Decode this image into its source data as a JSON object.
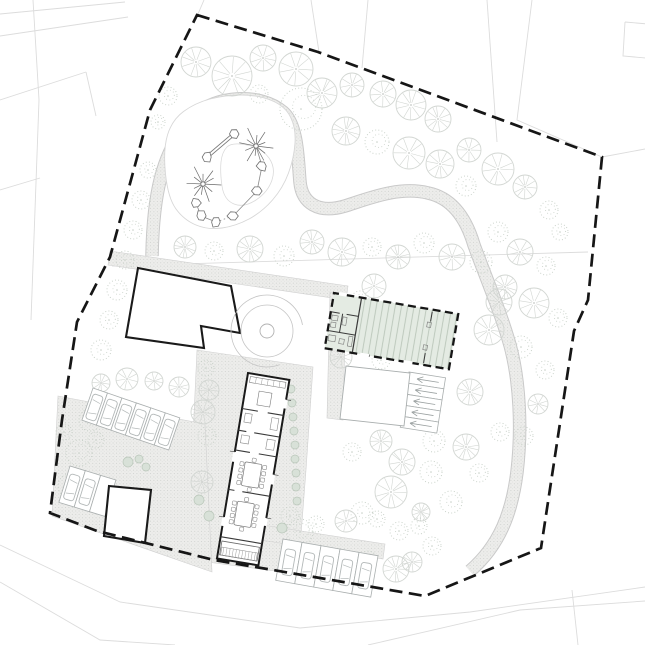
{
  "canvas": {
    "w": 645,
    "h": 645,
    "background": "#ffffff"
  },
  "colors": {
    "boundary": "#161616",
    "context_line": "#dcdcdc",
    "paving_edge": "#d0d0d0",
    "stipple_base": "#ededeb",
    "stipple_dot": "#c7cac7",
    "heavy_wall": "#1a1a1a",
    "thin_wall": "#3a3a3a",
    "light_outline": "#a9aeae",
    "car_line": "#b3b8b8",
    "tree_outline": "#d2d6d2",
    "tree_stipple": "#c6cfc6",
    "bush_fill": "#d8e1d8",
    "bush_edge": "#b9c6b9",
    "green_fill": "#e4ebe3",
    "green_hatch": "#b9c5b8",
    "equipment": "#6a6a6a",
    "circle_feature": "#c4c4c4",
    "blob_edge": "#d7d7d7"
  },
  "site_boundary": {
    "points": [
      [
        197,
        15
      ],
      [
        318,
        52
      ],
      [
        602,
        157
      ],
      [
        588,
        300
      ],
      [
        574,
        331
      ],
      [
        541,
        548
      ],
      [
        425,
        596
      ],
      [
        320,
        578
      ],
      [
        214,
        560
      ],
      [
        97,
        531
      ],
      [
        50,
        513
      ],
      [
        62,
        420
      ],
      [
        77,
        322
      ],
      [
        110,
        257
      ],
      [
        150,
        110
      ]
    ],
    "dash": "13 6.5",
    "width": 2.7
  },
  "context_lines": [
    [
      [
        204,
        0
      ],
      [
        198,
        14
      ]
    ],
    [
      [
        311,
        0
      ],
      [
        319,
        52
      ]
    ],
    [
      [
        368,
        0
      ],
      [
        362,
        68
      ]
    ],
    [
      [
        487,
        0
      ],
      [
        497,
        142
      ]
    ],
    [
      [
        532,
        0
      ],
      [
        517,
        120
      ],
      [
        602,
        157
      ]
    ],
    [
      [
        602,
        157
      ],
      [
        645,
        149
      ]
    ],
    [
      [
        625,
        22
      ],
      [
        648,
        24
      ],
      [
        646,
        58
      ],
      [
        623,
        56
      ],
      [
        625,
        22
      ]
    ],
    [
      [
        0,
        14
      ],
      [
        125,
        2
      ]
    ],
    [
      [
        0,
        36
      ],
      [
        128,
        17
      ]
    ],
    [
      [
        0,
        100
      ],
      [
        86,
        72
      ]
    ],
    [
      [
        86,
        72
      ],
      [
        96,
        116
      ]
    ],
    [
      [
        0,
        190
      ],
      [
        40,
        178
      ]
    ],
    [
      [
        33,
        0
      ],
      [
        39,
        100
      ],
      [
        31,
        320
      ]
    ],
    [
      [
        112,
        266
      ],
      [
        588,
        252
      ]
    ],
    [
      [
        0,
        545
      ],
      [
        120,
        602
      ],
      [
        300,
        628
      ],
      [
        470,
        612
      ],
      [
        645,
        587
      ]
    ],
    [
      [
        0,
        582
      ],
      [
        100,
        640
      ],
      [
        175,
        645
      ]
    ],
    [
      [
        368,
        645
      ],
      [
        520,
        610
      ],
      [
        645,
        601
      ]
    ],
    [
      [
        572,
        590
      ],
      [
        578,
        645
      ]
    ]
  ],
  "paving_polygons": [
    [
      [
        110,
        251
      ],
      [
        348,
        286
      ],
      [
        346,
        300
      ],
      [
        108,
        265
      ]
    ],
    [
      [
        330,
        292
      ],
      [
        346,
        294
      ],
      [
        343,
        420
      ],
      [
        327,
        418
      ]
    ],
    [
      [
        197,
        350
      ],
      [
        313,
        367
      ],
      [
        306,
        470
      ],
      [
        298,
        574
      ],
      [
        207,
        562
      ],
      [
        192,
        458
      ]
    ],
    [
      [
        58,
        396
      ],
      [
        205,
        424
      ],
      [
        212,
        572
      ],
      [
        52,
        516
      ]
    ],
    [
      [
        256,
        524
      ],
      [
        385,
        544
      ],
      [
        383,
        559
      ],
      [
        254,
        539
      ]
    ]
  ],
  "serpentine_path": {
    "d": "M152,256 C153,200 160,150 195,115 C215,96 260,92 283,112 C298,125 298,160 300,182 C302,203 318,214 345,206 C370,198 400,186 428,193 C452,198 466,218 474,245 C486,278 500,310 510,345 C520,382 522,430 517,472 C512,512 500,545 470,571",
    "outer_width": 13.5,
    "inner_width": 11.5
  },
  "playground": {
    "outer_blob": [
      [
        163,
        150
      ],
      [
        172,
        120
      ],
      [
        195,
        103
      ],
      [
        225,
        95
      ],
      [
        258,
        95
      ],
      [
        285,
        106
      ],
      [
        296,
        128
      ],
      [
        294,
        158
      ],
      [
        283,
        188
      ],
      [
        262,
        212
      ],
      [
        236,
        226
      ],
      [
        208,
        230
      ],
      [
        184,
        220
      ],
      [
        168,
        198
      ]
    ],
    "inner_blob": [
      [
        232,
        142
      ],
      [
        262,
        148
      ],
      [
        276,
        168
      ],
      [
        268,
        192
      ],
      [
        244,
        208
      ],
      [
        224,
        200
      ],
      [
        220,
        172
      ],
      [
        222,
        152
      ]
    ],
    "stars": [
      {
        "x": 256,
        "y": 146,
        "r": 18
      },
      {
        "x": 203,
        "y": 184,
        "r": 17
      }
    ],
    "beam": {
      "x1": 234,
      "y1": 134,
      "x2": 207,
      "y2": 157
    },
    "rocks": [
      [
        234,
        134
      ],
      [
        207,
        157
      ],
      [
        196,
        203
      ],
      [
        201,
        216
      ],
      [
        216,
        222
      ],
      [
        233,
        216
      ],
      [
        257,
        191
      ],
      [
        262,
        166
      ]
    ],
    "links": [
      {
        "a": [
          196,
          203
        ],
        "b": [
          201,
          216
        ],
        "dotted": false
      },
      {
        "a": [
          201,
          216
        ],
        "b": [
          216,
          222
        ],
        "dotted": false
      },
      {
        "a": [
          216,
          222
        ],
        "b": [
          233,
          216
        ],
        "dotted": true
      },
      {
        "a": [
          233,
          216
        ],
        "b": [
          257,
          191
        ],
        "dotted": false
      },
      {
        "a": [
          257,
          191
        ],
        "b": [
          262,
          166
        ],
        "dotted": false
      },
      {
        "a": [
          262,
          166
        ],
        "b": [
          256,
          146
        ],
        "dotted": false
      }
    ]
  },
  "trees": [
    [
      196,
      62,
      15,
      "o"
    ],
    [
      232,
      76,
      20,
      "o"
    ],
    [
      263,
      58,
      13,
      "o"
    ],
    [
      296,
      69,
      17,
      "o"
    ],
    [
      259,
      94,
      9,
      "s"
    ],
    [
      322,
      93,
      15,
      "o"
    ],
    [
      301,
      109,
      21,
      "s"
    ],
    [
      352,
      85,
      12,
      "o"
    ],
    [
      383,
      94,
      13,
      "o"
    ],
    [
      411,
      105,
      15,
      "o"
    ],
    [
      438,
      119,
      13,
      "o"
    ],
    [
      346,
      131,
      14,
      "o"
    ],
    [
      377,
      142,
      12,
      "s"
    ],
    [
      409,
      153,
      16,
      "o"
    ],
    [
      440,
      164,
      14,
      "o"
    ],
    [
      469,
      150,
      12,
      "o"
    ],
    [
      498,
      169,
      16,
      "o"
    ],
    [
      525,
      187,
      12,
      "o"
    ],
    [
      466,
      186,
      10,
      "s"
    ],
    [
      549,
      210,
      9,
      "s"
    ],
    [
      560,
      232,
      8,
      "s"
    ],
    [
      520,
      252,
      13,
      "o"
    ],
    [
      546,
      266,
      9,
      "s"
    ],
    [
      505,
      287,
      12,
      "o"
    ],
    [
      534,
      303,
      15,
      "o"
    ],
    [
      558,
      318,
      9,
      "s"
    ],
    [
      498,
      232,
      10,
      "s"
    ],
    [
      185,
      247,
      11,
      "o"
    ],
    [
      214,
      251,
      9,
      "s"
    ],
    [
      250,
      249,
      13,
      "o"
    ],
    [
      284,
      256,
      10,
      "s"
    ],
    [
      312,
      242,
      12,
      "o"
    ],
    [
      342,
      252,
      14,
      "o"
    ],
    [
      372,
      247,
      9,
      "s"
    ],
    [
      398,
      257,
      12,
      "o"
    ],
    [
      424,
      243,
      10,
      "s"
    ],
    [
      452,
      257,
      13,
      "o"
    ],
    [
      481,
      262,
      11,
      "s"
    ],
    [
      148,
      170,
      8,
      "s"
    ],
    [
      141,
      200,
      9,
      "s"
    ],
    [
      133,
      230,
      9,
      "s"
    ],
    [
      125,
      260,
      9,
      "s"
    ],
    [
      117,
      290,
      10,
      "s"
    ],
    [
      109,
      320,
      9,
      "s"
    ],
    [
      101,
      350,
      10,
      "s"
    ],
    [
      90,
      420,
      11,
      "s"
    ],
    [
      79,
      453,
      13,
      "s"
    ],
    [
      70,
      486,
      12,
      "s"
    ],
    [
      64,
      432,
      8,
      "s"
    ],
    [
      168,
      96,
      9,
      "s"
    ],
    [
      158,
      122,
      7,
      "s"
    ],
    [
      360,
      300,
      9,
      "s"
    ],
    [
      388,
      313,
      11,
      "o"
    ],
    [
      341,
      357,
      11,
      "o"
    ],
    [
      381,
      360,
      9,
      "s"
    ],
    [
      499,
      302,
      13,
      "o"
    ],
    [
      374,
      286,
      12,
      "o"
    ],
    [
      489,
      330,
      15,
      "o"
    ],
    [
      521,
      347,
      11,
      "s"
    ],
    [
      470,
      392,
      13,
      "o"
    ],
    [
      434,
      441,
      11,
      "s"
    ],
    [
      466,
      447,
      13,
      "o"
    ],
    [
      500,
      432,
      9,
      "s"
    ],
    [
      381,
      441,
      11,
      "o"
    ],
    [
      352,
      452,
      9,
      "s"
    ],
    [
      402,
      462,
      13,
      "o"
    ],
    [
      431,
      472,
      11,
      "s"
    ],
    [
      391,
      492,
      16,
      "o"
    ],
    [
      362,
      513,
      11,
      "s"
    ],
    [
      421,
      512,
      9,
      "o"
    ],
    [
      451,
      502,
      11,
      "s"
    ],
    [
      479,
      473,
      9,
      "s"
    ],
    [
      545,
      370,
      9,
      "s"
    ],
    [
      538,
      404,
      10,
      "o"
    ],
    [
      524,
      436,
      9,
      "s"
    ],
    [
      206,
      368,
      8,
      "s"
    ],
    [
      209,
      390,
      10,
      "o"
    ],
    [
      203,
      412,
      12,
      "o"
    ],
    [
      207,
      436,
      9,
      "s"
    ],
    [
      202,
      482,
      11,
      "o"
    ],
    [
      101,
      383,
      9,
      "o"
    ],
    [
      127,
      379,
      11,
      "o"
    ],
    [
      154,
      381,
      9,
      "o"
    ],
    [
      179,
      387,
      10,
      "o"
    ],
    [
      96,
      440,
      8,
      "s"
    ],
    [
      316,
      524,
      8,
      "s"
    ],
    [
      346,
      521,
      11,
      "o"
    ],
    [
      377,
      519,
      8,
      "s"
    ],
    [
      399,
      531,
      9,
      "s"
    ],
    [
      419,
      526,
      8,
      "s"
    ],
    [
      432,
      546,
      9,
      "s"
    ],
    [
      396,
      569,
      13,
      "o"
    ],
    [
      368,
      560,
      9,
      "s"
    ],
    [
      412,
      562,
      10,
      "o"
    ],
    [
      290,
      516,
      9,
      "s"
    ],
    [
      300,
      532,
      13,
      "s"
    ],
    [
      128,
      462,
      5,
      "b"
    ],
    [
      139,
      459,
      4,
      "b"
    ],
    [
      146,
      467,
      4,
      "b"
    ],
    [
      291,
      389,
      4,
      "b"
    ],
    [
      292,
      403,
      4,
      "b"
    ],
    [
      293,
      417,
      4,
      "b"
    ],
    [
      294,
      431,
      4,
      "b"
    ],
    [
      295,
      445,
      4,
      "b"
    ],
    [
      295,
      459,
      4,
      "b"
    ],
    [
      296,
      473,
      4,
      "b"
    ],
    [
      296,
      487,
      4,
      "b"
    ],
    [
      297,
      501,
      4,
      "b"
    ],
    [
      282,
      528,
      5,
      "b"
    ],
    [
      199,
      500,
      5,
      "b"
    ],
    [
      209,
      516,
      5,
      "b"
    ]
  ],
  "parking_rows": [
    {
      "x": 93,
      "y": 388,
      "angle": 19,
      "n": 6,
      "w": 15.3,
      "d": 34,
      "cars": [
        1,
        1,
        1,
        1,
        1,
        1
      ]
    },
    {
      "x": 70,
      "y": 466,
      "angle": 17,
      "n": 3,
      "w": 16,
      "d": 38,
      "cars": [
        1,
        1,
        0
      ]
    },
    {
      "x": 283,
      "y": 539,
      "angle": 10,
      "n": 5,
      "w": 19.3,
      "d": 42,
      "cars": [
        1,
        1,
        1,
        1,
        1
      ]
    }
  ],
  "arrow_stalls": {
    "x": 409,
    "y": 372,
    "angle": 9,
    "n": 5,
    "w": 37,
    "h": 11.2
  },
  "buildings": {
    "l_building": {
      "points": [
        [
          138,
          268
        ],
        [
          231,
          286
        ],
        [
          240,
          333
        ],
        [
          201,
          326
        ],
        [
          204,
          348
        ],
        [
          126,
          337
        ]
      ]
    },
    "small_building": {
      "points": [
        [
          109,
          486
        ],
        [
          151,
          490
        ],
        [
          145,
          543
        ],
        [
          104,
          536
        ]
      ]
    },
    "barn": {
      "points": [
        [
          346,
          366
        ],
        [
          410,
          373
        ],
        [
          404,
          426
        ],
        [
          340,
          419
        ]
      ]
    },
    "long_building": {
      "x": 248,
      "y": 373,
      "angle": 9.5,
      "w": 42,
      "l": 188,
      "crosswalls": [
        [
          0,
          36,
          16,
          36
        ],
        [
          26,
          36,
          42,
          36
        ],
        [
          0,
          58,
          8,
          58
        ],
        [
          16,
          58,
          42,
          58
        ],
        [
          0,
          78,
          15,
          78
        ],
        [
          24,
          78,
          42,
          78
        ],
        [
          0,
          118,
          6,
          118
        ],
        [
          14,
          118,
          42,
          118
        ],
        [
          0,
          166,
          42,
          166
        ]
      ],
      "counter": [
        3,
        3,
        36,
        6
      ],
      "counter_ticks": [
        9,
        15,
        21,
        27,
        33
      ],
      "island": [
        14,
        16,
        13,
        14
      ],
      "fixtures": [
        [
          4,
          40,
          7,
          9
        ],
        [
          31,
          40,
          7,
          12
        ],
        [
          4,
          62,
          8,
          8
        ],
        [
          30,
          62,
          8,
          10
        ]
      ],
      "tables": [
        {
          "t": [
            12,
            88,
            17,
            24
          ]
        },
        {
          "t": [
            11,
            128,
            17,
            24
          ]
        }
      ],
      "porch": [
        2,
        170,
        38,
        14
      ],
      "porch_band": [
        3,
        176,
        36,
        8
      ],
      "door_gaps": [
        [
          -1.6,
          80,
          3.2,
          10
        ],
        [
          -1.6,
          146,
          3.2,
          9
        ],
        [
          40.4,
          96,
          3.2,
          10
        ],
        [
          40.4,
          20,
          3.2,
          9
        ],
        [
          40.4,
          140,
          3.2,
          8
        ]
      ]
    },
    "green_building": {
      "x": 334,
      "y": 293,
      "angle": 9.6,
      "w": 126,
      "h": 56,
      "partition_x": 28,
      "walls": [
        [
          1,
          19,
          9,
          19
        ],
        [
          16,
          19,
          28,
          19
        ],
        [
          1,
          38,
          28,
          38
        ],
        [
          12,
          19,
          12,
          38
        ],
        [
          100,
          2,
          100,
          12
        ],
        [
          100,
          44,
          100,
          54
        ]
      ],
      "fixtures": [
        [
          2,
          22,
          6,
          5
        ],
        [
          2,
          29,
          5,
          5
        ],
        [
          13,
          22,
          4,
          8
        ],
        [
          2,
          42,
          7,
          6
        ],
        [
          13,
          44,
          5,
          5
        ],
        [
          22,
          40,
          4,
          10
        ],
        [
          97,
          13,
          4,
          5
        ],
        [
          97,
          36,
          4,
          5
        ]
      ],
      "door_gaps": [
        [
          5,
          -1.8,
          8,
          3.4
        ],
        [
          36,
          54.4,
          9,
          3.4
        ],
        [
          80,
          54.4,
          9,
          3.4
        ]
      ],
      "dash": "8 4.5"
    }
  },
  "circle_feature": {
    "cx": 267,
    "cy": 331,
    "r_inner": 7,
    "r_mid": 26,
    "r_arc": 36
  }
}
